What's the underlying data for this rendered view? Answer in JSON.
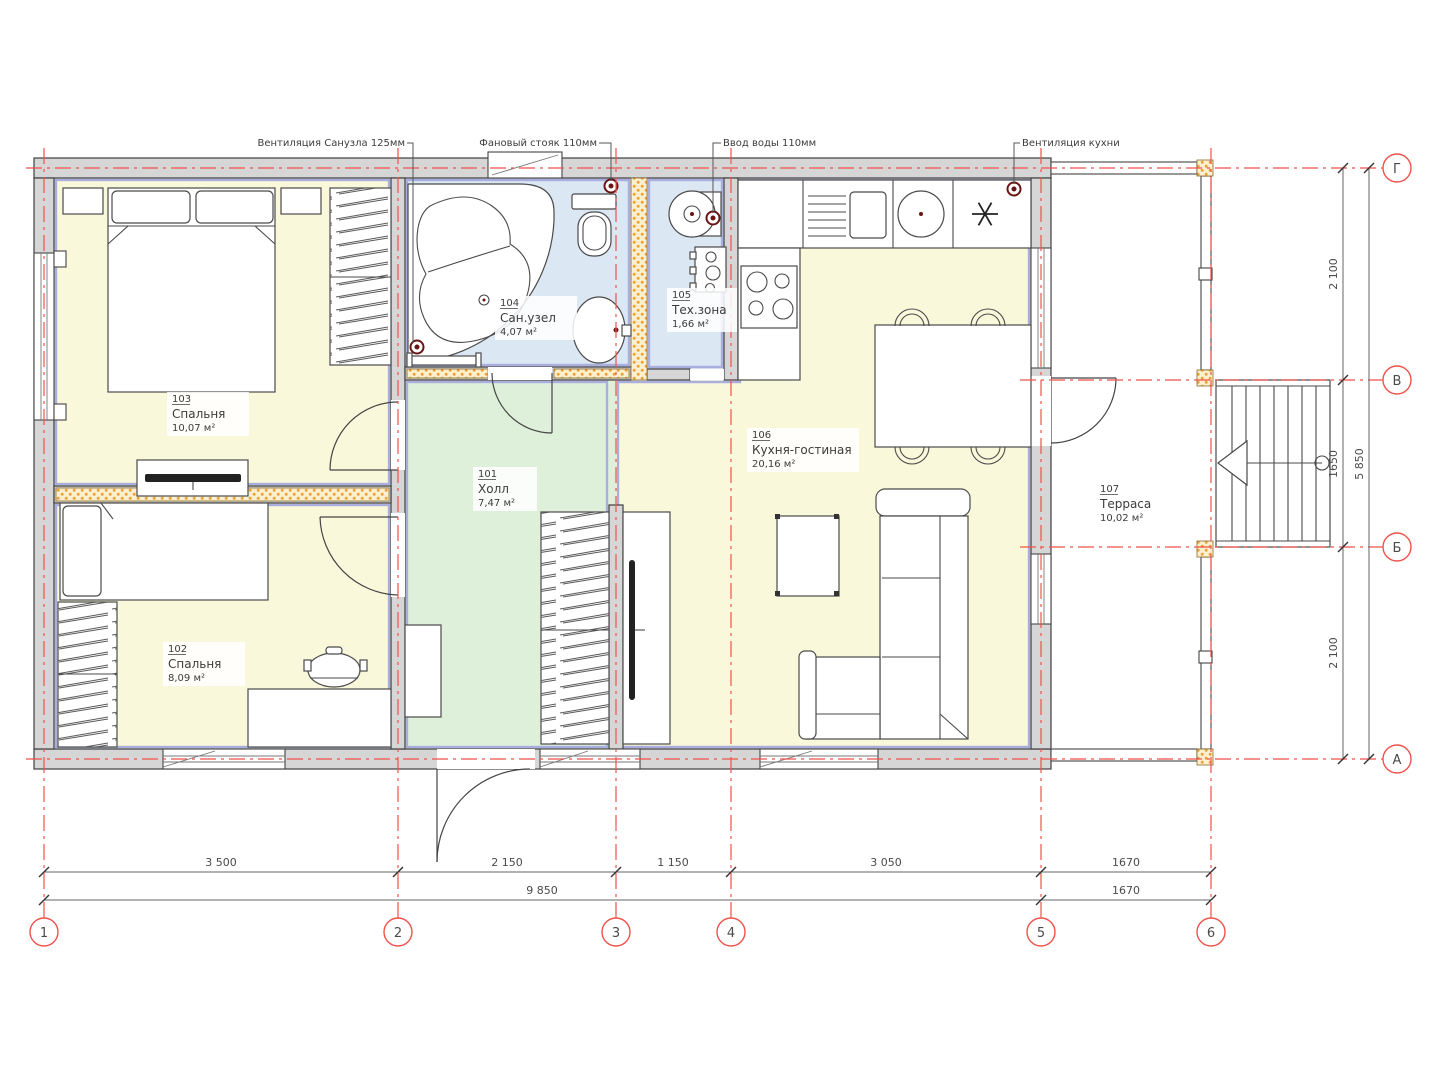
{
  "annotations": {
    "vent_bathroom": "Вентиляция Санузла 125мм",
    "sewer_riser": "Фановый стояк 110мм",
    "water_inlet": "Ввод воды 110мм",
    "vent_kitchen": "Вентиляция кухни"
  },
  "rooms": {
    "hall": {
      "number": "101",
      "name": "Холл",
      "area": "7,47 м²"
    },
    "bedroom2": {
      "number": "102",
      "name": "Спальня",
      "area": "8,09 м²"
    },
    "bedroom1": {
      "number": "103",
      "name": "Спальня",
      "area": "10,07 м²"
    },
    "bathroom": {
      "number": "104",
      "name": "Сан.узел",
      "area": "4,07 м²"
    },
    "tech": {
      "number": "105",
      "name": "Тех.зона",
      "area": "1,66 м²"
    },
    "kitchen_living": {
      "number": "106",
      "name": "Кухня-гостиная",
      "area": "20,16 м²"
    },
    "terrace": {
      "number": "107",
      "name": "Терраса",
      "area": "10,02 м²"
    }
  },
  "axes": {
    "columns": [
      "1",
      "2",
      "3",
      "4",
      "5",
      "6"
    ],
    "rows": [
      "Г",
      "В",
      "Б",
      "А"
    ]
  },
  "dimensions": {
    "bottom_segments": [
      "3 500",
      "2 150",
      "1 150",
      "3 050",
      "1670"
    ],
    "bottom_total": "9 850",
    "bottom_terrace": "1670",
    "right_segments": [
      "2 100",
      "1650",
      "2 100"
    ],
    "right_total": "5 850"
  },
  "colors": {
    "axis_red": "#f0524a",
    "wall_gray": "#d6d6d6",
    "room_yellow": "#faf8da",
    "room_blue": "#dbe7f3",
    "room_green": "#dff0da",
    "inner_lavender": "#a9aede",
    "insulation_orange": "#eca23c"
  }
}
